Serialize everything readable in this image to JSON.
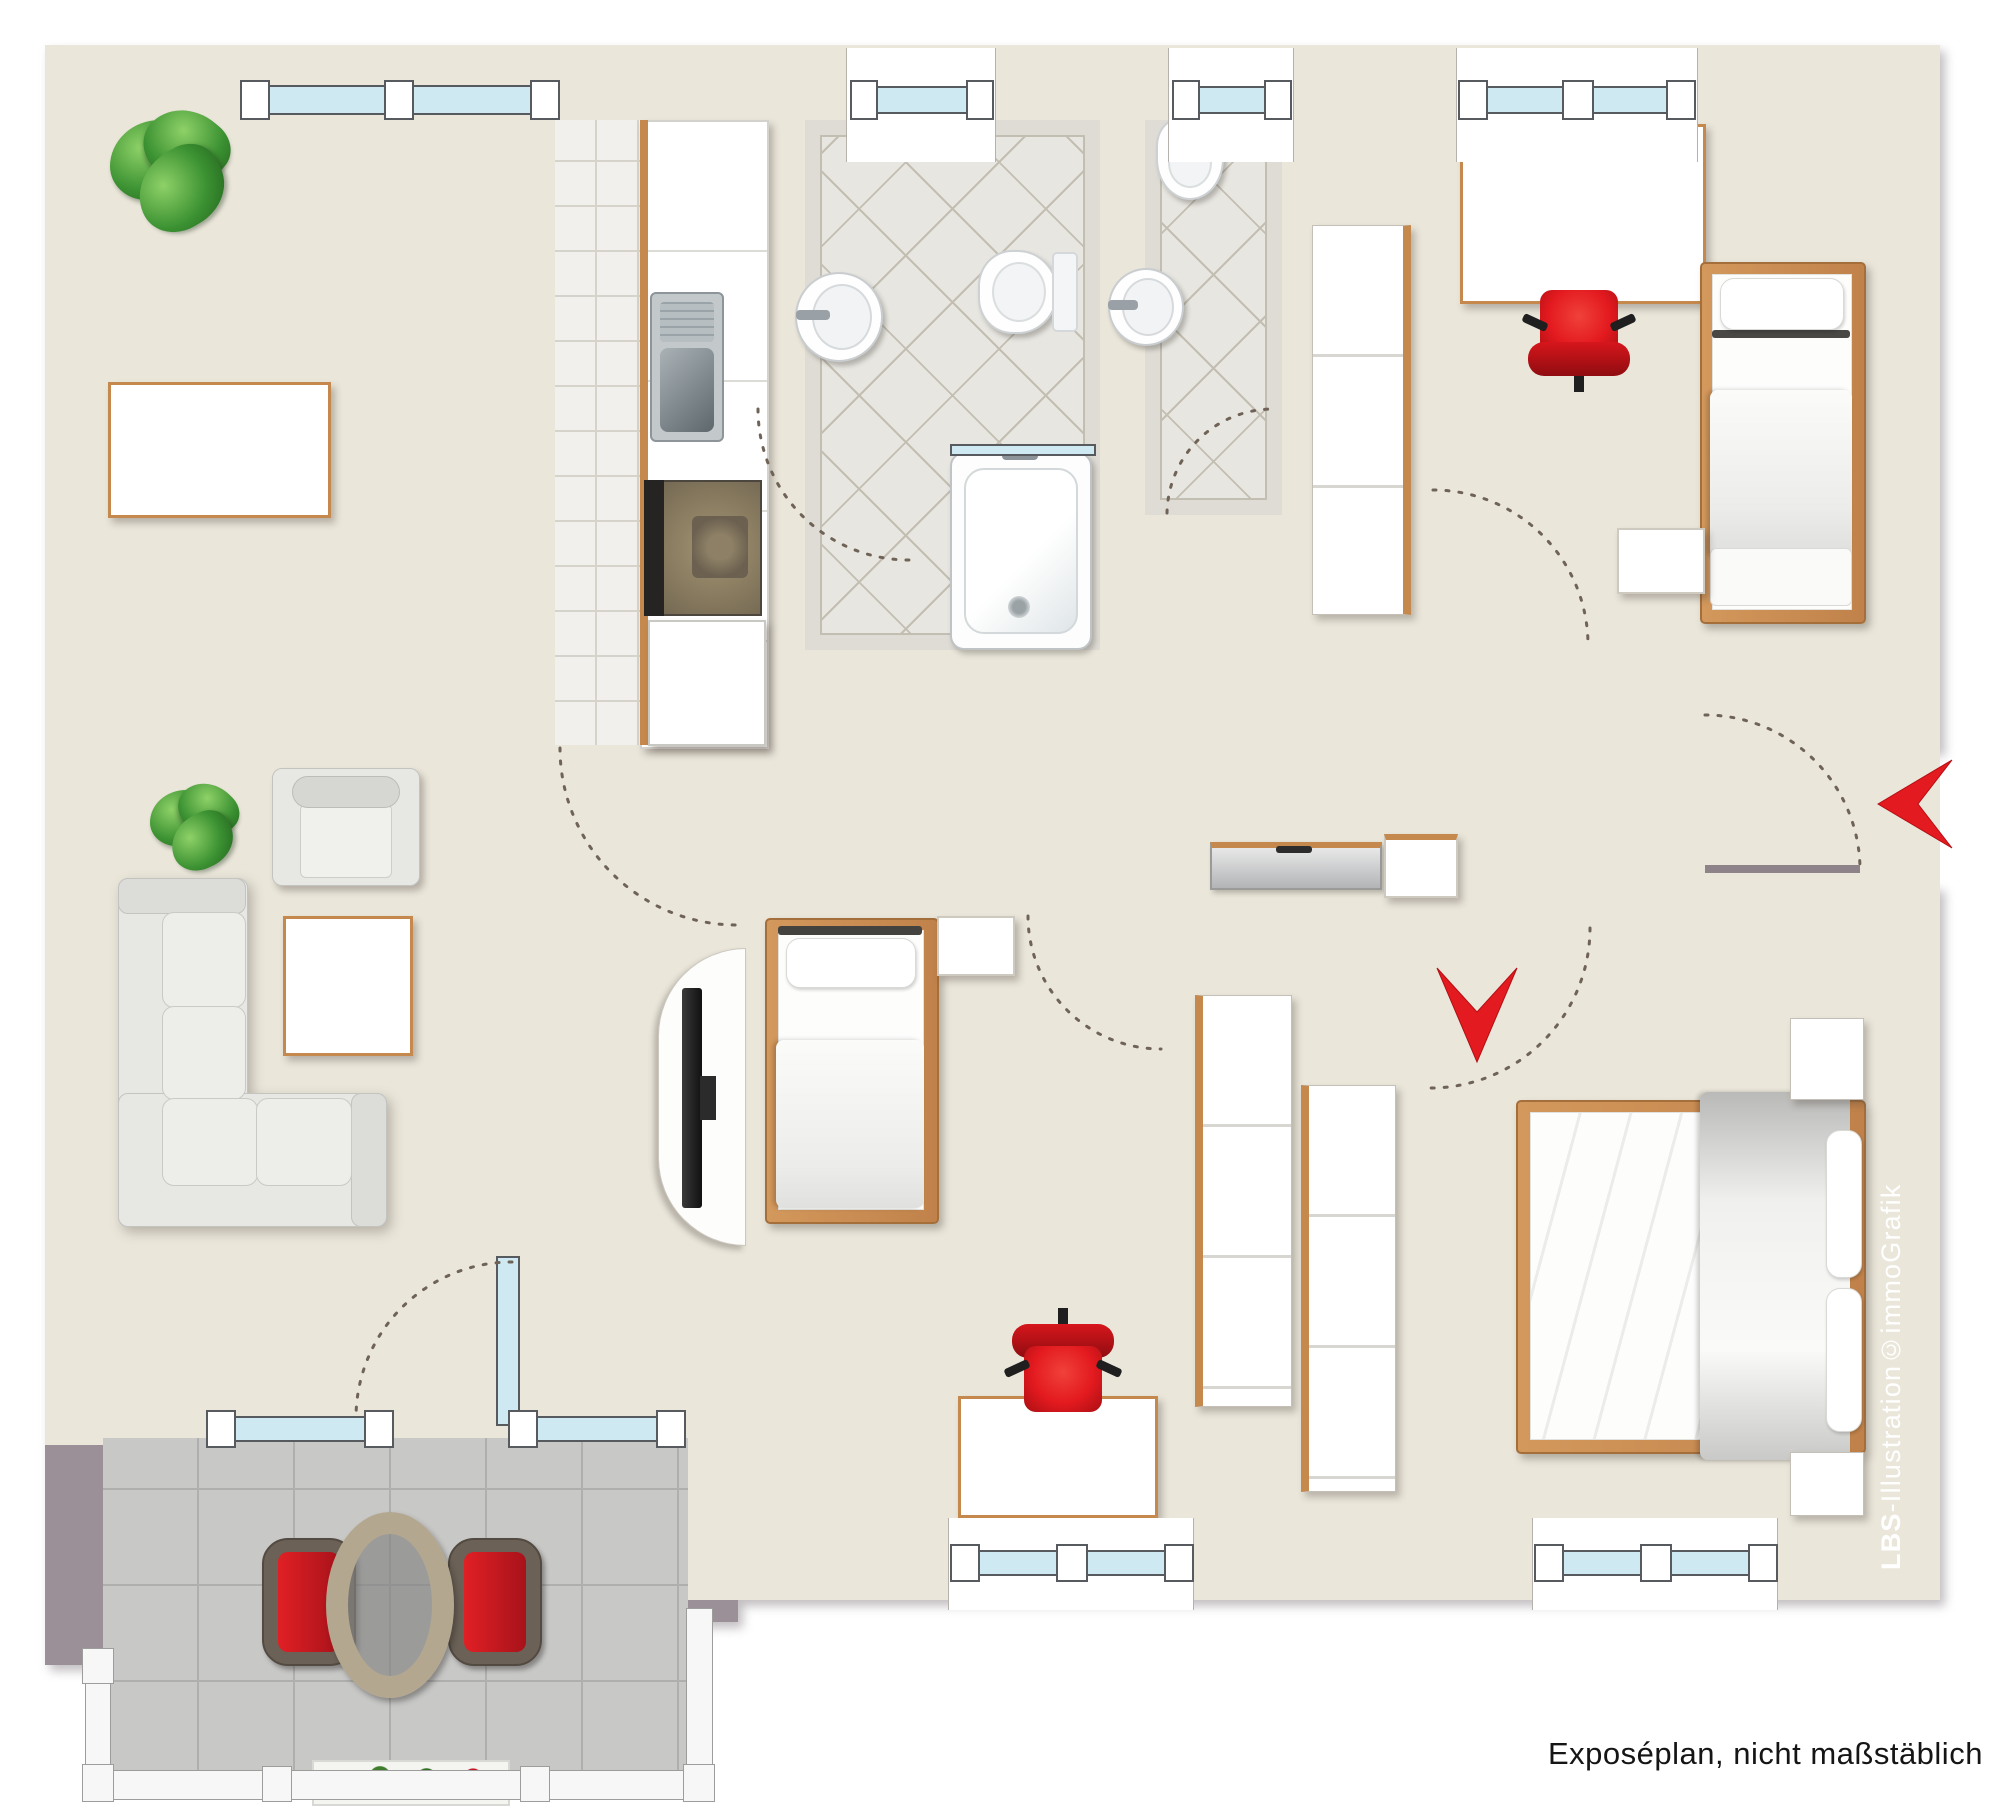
{
  "annotations": {
    "disclaimer": "Exposéplan, nicht maßstäblich",
    "watermark_bold": "LBS",
    "watermark_rest": "-Illustration©immoGrafik"
  },
  "markers": {
    "entrance_arrow": "chevron-left",
    "bedroom_entry_arrow": "chevron-down"
  },
  "palette": {
    "wall": "#9b9097",
    "floor": "#eae6da",
    "kitchen_tile": "#f1f0ec",
    "bath_tile": "#e8e6e0",
    "band": "#dfdcd5",
    "tile_line": "#d6d3ca",
    "diag_line": "#c2beb2",
    "balcony_tile": "#c8c8c7",
    "balcony_line": "#afafae",
    "glass": "#cfe9f3",
    "frame": "#575a5e",
    "wood": "#c5894e",
    "sofa": "#e7e7e4",
    "red": "#e31a1f",
    "red_dark": "#a90f13",
    "arc": "#6f6256",
    "railing": "#f7f7f7"
  }
}
